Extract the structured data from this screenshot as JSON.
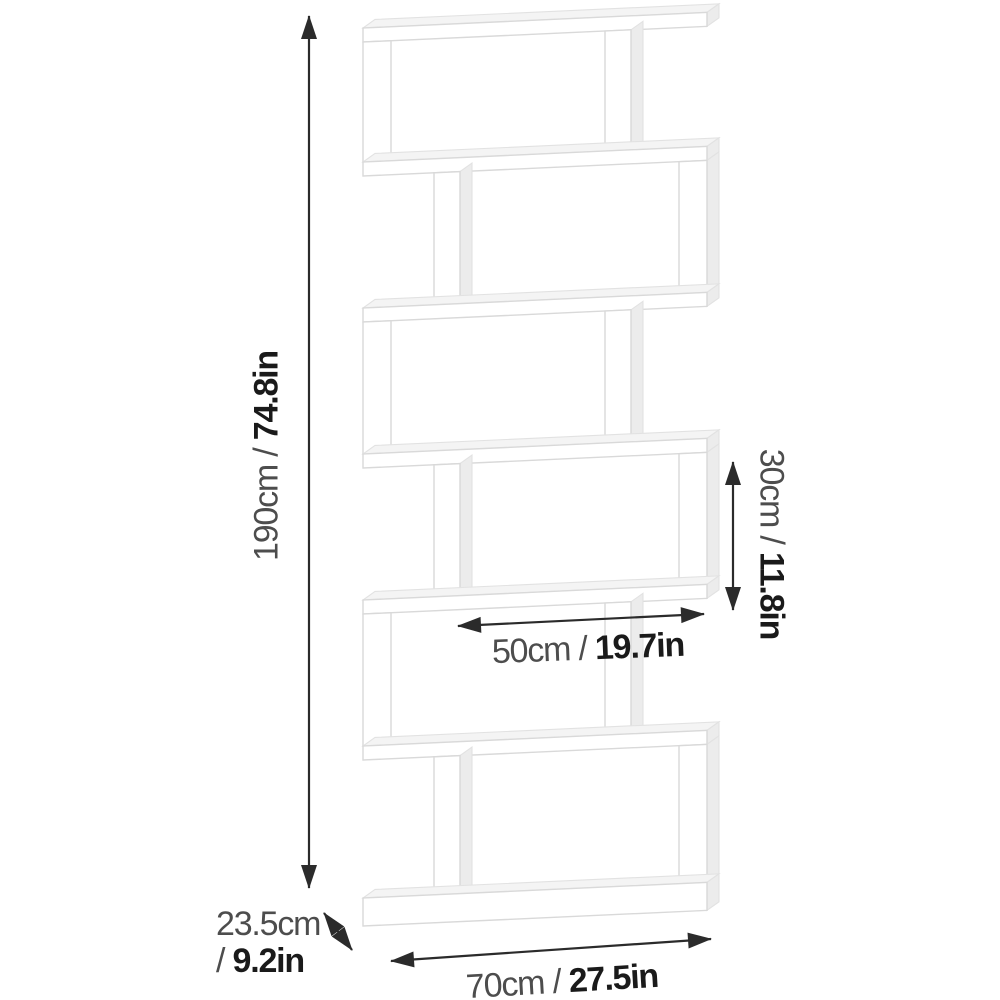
{
  "diagram": {
    "subject": "6-tier S-shaped bookshelf dimension diagram",
    "dimensions": {
      "height": {
        "prefix": "190cm / ",
        "bold": "74.8in"
      },
      "shelf_opening_height": {
        "prefix": "30cm / ",
        "bold": "11.8in"
      },
      "shelf_width": {
        "prefix": "50cm / ",
        "bold": "19.7in"
      },
      "depth": {
        "line1": "23.5cm",
        "prefix": "/ ",
        "bold": "9.2in"
      },
      "width": {
        "prefix": "70cm / ",
        "bold": "27.5in"
      }
    },
    "colors": {
      "background": "#ffffff",
      "label_regular": "#4d4d4d",
      "label_bold": "#1a1a1a",
      "dimension_line": "#2b2b2b",
      "shelf_outline": "#d9d9d9",
      "shelf_face": "#ffffff",
      "shelf_top_surface": "#f4f4f4",
      "shelf_side_surface": "#ececec"
    }
  }
}
